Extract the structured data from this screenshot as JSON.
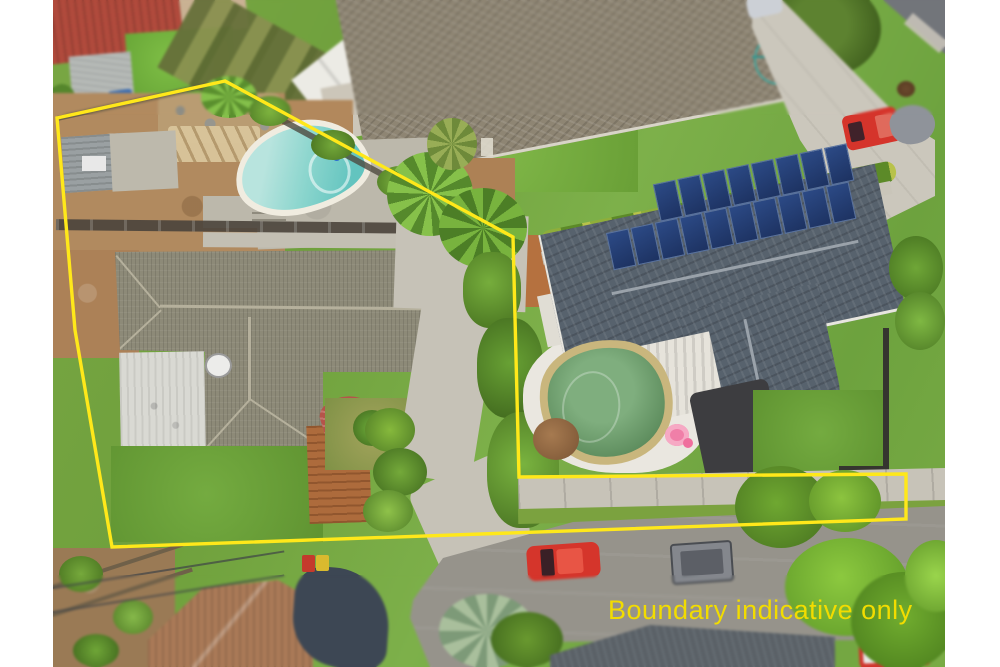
{
  "overlay": {
    "caption": "Boundary indicative only",
    "caption_color": "#f2dc00",
    "boundary_color": "#ffe81a",
    "boundary_stroke_width": 3.4,
    "boundary_points": "225,81 513,237 519,477 906,474 906,519 112,547 75,330 57,118"
  },
  "scene": {
    "type": "aerial-photograph",
    "subject": "residential property with two dwellings, two pools and street frontage",
    "solar_panel_rows": [
      8,
      10
    ],
    "features": [
      "left-house-tiled-roof",
      "white-garage-roof",
      "kidney-pool",
      "garden-shed",
      "timber-deck",
      "right-house-dark-roof",
      "solar-panel-array",
      "lagoon-pool",
      "flamingo-floatie",
      "white-pergola",
      "red-ute",
      "covered-trailer",
      "street",
      "footpath",
      "red-parked-car",
      "neighbour-houses",
      "shade-sail",
      "wheelie-bins",
      "palm-trees"
    ],
    "colors": {
      "kidney_pool_water": "#7fcfc9",
      "lagoon_pool_water": "#6a9d6b",
      "right_roof": "#57626d",
      "left_roof": "#8d8a78",
      "grass": "#74a83e",
      "dirt": "#b18a5f",
      "concrete": "#c7c3b8",
      "road": "#96938b",
      "solar_panel": "#24386b",
      "deck_timber": "#ad6b3c",
      "flamingo_pink": "#f07fa8",
      "red_car": "#d5352b"
    }
  }
}
